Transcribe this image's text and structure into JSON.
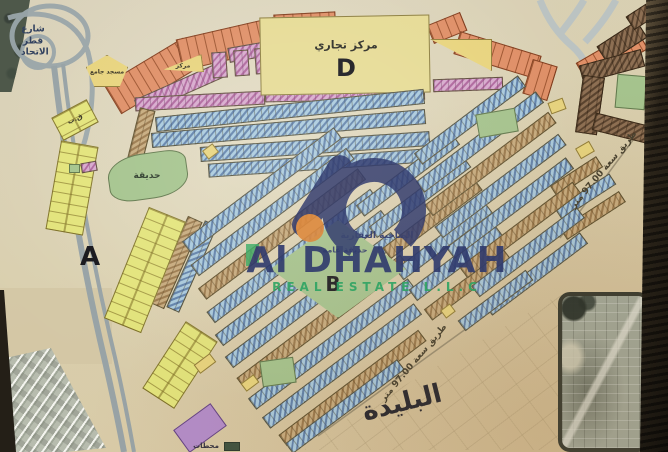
{
  "watermark": {
    "name": "Al DHAHYAH",
    "subtitle": "REAL ESTATE L.L.C",
    "arabic_name": "الضاحية العقارية",
    "colors": {
      "navy": "#2f3a6d",
      "green": "#2ea463",
      "orange": "#dd8a3f"
    }
  },
  "map": {
    "zone_letters": [
      "A",
      "B",
      "D"
    ],
    "colors": {
      "residential_blue": "#a9cade",
      "residential_khaki": "#c7ab7e",
      "commercial_pink": "#d7a9cd",
      "plots_orange": "#df8f67",
      "plots_yellow": "#e3e47c",
      "special_brown": "#8d6f53",
      "park_green": "#a5c48e",
      "utility_purple": "#b38cc9",
      "big_block_yellow": "#e6db95"
    },
    "labels": [
      {
        "id": "zone-label-a",
        "text": "A",
        "cx": 90,
        "cy": 257,
        "size": 26,
        "weight": 800,
        "color": "#17171c"
      },
      {
        "id": "zone-label-b",
        "text": "B",
        "cx": 333,
        "cy": 284,
        "size": 20,
        "weight": 800,
        "color": "#17171c"
      },
      {
        "id": "zone-label-d",
        "text": "D",
        "cx": 346,
        "cy": 68,
        "size": 24,
        "weight": 800,
        "color": "#17171c"
      },
      {
        "id": "commercial-center-label",
        "text": "مركز تجاري",
        "cx": 346,
        "cy": 45,
        "size": 11,
        "weight": 700,
        "color": "#2b2b25"
      },
      {
        "id": "park-left-label",
        "text": "حديقة",
        "cx": 147,
        "cy": 176,
        "size": 9,
        "weight": 700,
        "color": "#2e3c2c"
      },
      {
        "id": "park-b-label",
        "text": "حديقة عامة",
        "cx": 345,
        "cy": 250,
        "size": 8,
        "weight": 700,
        "color": "#33406b"
      },
      {
        "id": "district-name-label",
        "text": "البليدة",
        "cx": 402,
        "cy": 403,
        "size": 26,
        "weight": 800,
        "color": "#26262e",
        "rot": -14
      },
      {
        "id": "road-97-right-label",
        "text": "طريق سعة 97.00 متر",
        "cx": 604,
        "cy": 170,
        "size": 9,
        "weight": 700,
        "color": "#453f2e",
        "rot": -50
      },
      {
        "id": "road-97-bottom-label",
        "text": "طريق سعة 97.00 متر",
        "cx": 414,
        "cy": 363,
        "size": 9,
        "weight": 700,
        "color": "#453f2e",
        "rot": -50
      },
      {
        "id": "street-left-label",
        "text": "شارع قطر الاتحاد",
        "cx": 33,
        "cy": 42,
        "size": 9,
        "weight": 700,
        "color": "#31415f",
        "w": 24,
        "cls": "lbl-wrap"
      },
      {
        "id": "mosque-label",
        "text": "مسجد جامع",
        "cx": 107,
        "cy": 72,
        "size": 6,
        "weight": 700,
        "color": "#3a3525"
      },
      {
        "id": "center-small-label",
        "text": "مركز",
        "cx": 183,
        "cy": 66,
        "size": 6,
        "weight": 700,
        "color": "#3a3525"
      },
      {
        "id": "stations-label",
        "text": "محطات",
        "cx": 206,
        "cy": 446,
        "size": 7,
        "weight": 700,
        "color": "#33303f"
      },
      {
        "id": "qb-label",
        "text": "ق.ب",
        "cx": 75,
        "cy": 119,
        "size": 7,
        "weight": 700,
        "color": "#3a3525",
        "rot": -25
      }
    ],
    "blocks": [
      {
        "cx": 152,
        "cy": 76,
        "w": 92,
        "h": 34,
        "r": -31,
        "p": "orange"
      },
      {
        "cx": 228,
        "cy": 44,
        "w": 100,
        "h": 32,
        "r": -13,
        "p": "orange"
      },
      {
        "cx": 305,
        "cy": 27,
        "w": 62,
        "h": 28,
        "r": -3,
        "p": "orange"
      },
      {
        "cx": 447,
        "cy": 28,
        "w": 36,
        "h": 20,
        "r": -22,
        "p": "orange"
      },
      {
        "cx": 497,
        "cy": 55,
        "w": 85,
        "h": 24,
        "r": 17,
        "p": "orange"
      },
      {
        "cx": 540,
        "cy": 80,
        "w": 26,
        "h": 36,
        "r": 17,
        "p": "orange"
      },
      {
        "cx": 612,
        "cy": 56,
        "w": 70,
        "h": 24,
        "r": -30,
        "p": "orange"
      },
      {
        "cx": 180,
        "cy": 88,
        "w": 95,
        "h": 16,
        "r": -24,
        "p": "pink"
      },
      {
        "cx": 268,
        "cy": 48,
        "w": 80,
        "h": 15,
        "r": -10,
        "p": "pink"
      },
      {
        "cx": 219,
        "cy": 65,
        "w": 15,
        "h": 26,
        "r": -4,
        "p": "pink"
      },
      {
        "cx": 241,
        "cy": 63,
        "w": 15,
        "h": 26,
        "r": -4,
        "p": "pink"
      },
      {
        "cx": 262,
        "cy": 61,
        "w": 15,
        "h": 26,
        "r": -4,
        "p": "pink"
      },
      {
        "cx": 200,
        "cy": 101,
        "w": 130,
        "h": 14,
        "r": -3,
        "p": "pink"
      },
      {
        "cx": 345,
        "cy": 94,
        "w": 160,
        "h": 13,
        "r": -1,
        "p": "pink"
      },
      {
        "cx": 468,
        "cy": 84,
        "w": 70,
        "h": 13,
        "r": -2,
        "p": "pink"
      },
      {
        "cx": 345,
        "cy": 55,
        "w": 170,
        "h": 78,
        "r": -1,
        "p": "bigyellow"
      },
      {
        "cx": 622,
        "cy": 42,
        "w": 48,
        "h": 20,
        "r": -33,
        "p": "brown"
      },
      {
        "cx": 640,
        "cy": 17,
        "w": 24,
        "h": 16,
        "r": -33,
        "p": "brown"
      },
      {
        "cx": 612,
        "cy": 66,
        "w": 64,
        "h": 18,
        "r": -15,
        "p": "brown"
      },
      {
        "cx": 590,
        "cy": 105,
        "w": 22,
        "h": 58,
        "r": 8,
        "p": "brown"
      },
      {
        "cx": 621,
        "cy": 128,
        "w": 56,
        "h": 18,
        "r": 14,
        "p": "brown"
      },
      {
        "cx": 576,
        "cy": 176,
        "w": 55,
        "h": 13,
        "r": -33,
        "p": "khaki"
      },
      {
        "cx": 585,
        "cy": 196,
        "w": 65,
        "h": 13,
        "r": -33,
        "p": "blue"
      },
      {
        "cx": 593,
        "cy": 215,
        "w": 70,
        "h": 13,
        "r": -33,
        "p": "khaki"
      },
      {
        "cx": 290,
        "cy": 110,
        "w": 270,
        "h": 15,
        "r": -6,
        "p": "blue"
      },
      {
        "cx": 288,
        "cy": 128,
        "w": 275,
        "h": 15,
        "r": -5,
        "p": "blue"
      },
      {
        "cx": 315,
        "cy": 146,
        "w": 230,
        "h": 15,
        "r": -4,
        "p": "blue"
      },
      {
        "cx": 318,
        "cy": 163,
        "w": 220,
        "h": 14,
        "r": -4,
        "p": "blue"
      },
      {
        "cx": 138,
        "cy": 148,
        "w": 16,
        "h": 80,
        "r": 14,
        "p": "khaki"
      },
      {
        "cx": 176,
        "cy": 262,
        "w": 16,
        "h": 95,
        "r": 24,
        "p": "khaki"
      },
      {
        "cx": 192,
        "cy": 266,
        "w": 14,
        "h": 95,
        "r": 24,
        "p": "blue"
      },
      {
        "cx": 262,
        "cy": 190,
        "w": 190,
        "h": 14,
        "r": -37,
        "p": "blue"
      },
      {
        "cx": 272,
        "cy": 212,
        "w": 195,
        "h": 14,
        "r": -37,
        "p": "blue"
      },
      {
        "cx": 282,
        "cy": 234,
        "w": 200,
        "h": 14,
        "r": -37,
        "p": "khaki"
      },
      {
        "cx": 292,
        "cy": 256,
        "w": 205,
        "h": 14,
        "r": -37,
        "p": "blue"
      },
      {
        "cx": 302,
        "cy": 278,
        "w": 208,
        "h": 14,
        "r": -37,
        "p": "blue"
      },
      {
        "cx": 312,
        "cy": 300,
        "w": 208,
        "h": 14,
        "r": -37,
        "p": "blue"
      },
      {
        "cx": 322,
        "cy": 322,
        "w": 205,
        "h": 14,
        "r": -37,
        "p": "khaki"
      },
      {
        "cx": 332,
        "cy": 344,
        "w": 200,
        "h": 14,
        "r": -37,
        "p": "blue"
      },
      {
        "cx": 342,
        "cy": 366,
        "w": 190,
        "h": 14,
        "r": -37,
        "p": "blue"
      },
      {
        "cx": 352,
        "cy": 388,
        "w": 175,
        "h": 14,
        "r": -37,
        "p": "khaki"
      },
      {
        "cx": 345,
        "cy": 406,
        "w": 140,
        "h": 13,
        "r": -37,
        "p": "blue"
      },
      {
        "cx": 408,
        "cy": 175,
        "w": 120,
        "h": 14,
        "r": -37,
        "p": "blue"
      },
      {
        "cx": 420,
        "cy": 197,
        "w": 118,
        "h": 14,
        "r": -37,
        "p": "blue"
      },
      {
        "cx": 432,
        "cy": 219,
        "w": 115,
        "h": 14,
        "r": -37,
        "p": "khaki"
      },
      {
        "cx": 444,
        "cy": 241,
        "w": 112,
        "h": 14,
        "r": -37,
        "p": "blue"
      },
      {
        "cx": 456,
        "cy": 263,
        "w": 108,
        "h": 14,
        "r": -37,
        "p": "blue"
      },
      {
        "cx": 468,
        "cy": 285,
        "w": 100,
        "h": 14,
        "r": -37,
        "p": "khaki"
      },
      {
        "cx": 470,
        "cy": 120,
        "w": 130,
        "h": 14,
        "r": -37,
        "p": "blue"
      },
      {
        "cx": 480,
        "cy": 142,
        "w": 150,
        "h": 14,
        "r": -37,
        "p": "blue"
      },
      {
        "cx": 490,
        "cy": 164,
        "w": 155,
        "h": 14,
        "r": -37,
        "p": "khaki"
      },
      {
        "cx": 500,
        "cy": 186,
        "w": 155,
        "h": 14,
        "r": -37,
        "p": "blue"
      },
      {
        "cx": 510,
        "cy": 208,
        "w": 150,
        "h": 14,
        "r": -37,
        "p": "blue"
      },
      {
        "cx": 520,
        "cy": 230,
        "w": 142,
        "h": 14,
        "r": -37,
        "p": "khaki"
      },
      {
        "cx": 528,
        "cy": 252,
        "w": 132,
        "h": 14,
        "r": -37,
        "p": "blue"
      },
      {
        "cx": 536,
        "cy": 274,
        "w": 120,
        "h": 14,
        "r": -37,
        "p": "blue"
      },
      {
        "cx": 495,
        "cy": 300,
        "w": 85,
        "h": 13,
        "r": -37,
        "p": "blue"
      },
      {
        "cx": 72,
        "cy": 188,
        "w": 38,
        "h": 90,
        "r": 10,
        "p": "yellow"
      },
      {
        "cx": 145,
        "cy": 270,
        "w": 40,
        "h": 120,
        "r": 22,
        "p": "yellow"
      },
      {
        "cx": 180,
        "cy": 365,
        "w": 38,
        "h": 80,
        "r": 33,
        "p": "yellow"
      },
      {
        "cx": 75,
        "cy": 120,
        "w": 40,
        "h": 26,
        "r": -28,
        "p": "yellow"
      },
      {
        "cx": 107,
        "cy": 71,
        "w": 42,
        "h": 32,
        "r": 0,
        "p": "gold",
        "s": "pent"
      },
      {
        "cx": 183,
        "cy": 66,
        "w": 40,
        "h": 18,
        "r": -8,
        "p": "gold",
        "s": "tri-l"
      },
      {
        "cx": 461,
        "cy": 55,
        "w": 62,
        "h": 32,
        "r": 0,
        "p": "gold",
        "s": "tri-r"
      },
      {
        "cx": 585,
        "cy": 150,
        "w": 16,
        "h": 12,
        "r": -30,
        "p": "gold"
      },
      {
        "cx": 557,
        "cy": 106,
        "w": 16,
        "h": 12,
        "r": -20,
        "p": "gold"
      },
      {
        "cx": 210,
        "cy": 151,
        "w": 13,
        "h": 11,
        "r": -37,
        "p": "gold"
      },
      {
        "cx": 205,
        "cy": 363,
        "w": 20,
        "h": 11,
        "r": -37,
        "p": "gold"
      },
      {
        "cx": 250,
        "cy": 383,
        "w": 16,
        "h": 10,
        "r": -37,
        "p": "gold"
      },
      {
        "cx": 352,
        "cy": 300,
        "w": 13,
        "h": 10,
        "r": -37,
        "p": "gold"
      },
      {
        "cx": 448,
        "cy": 311,
        "w": 12,
        "h": 10,
        "r": -37,
        "p": "gold"
      },
      {
        "cx": 148,
        "cy": 176,
        "w": 80,
        "h": 46,
        "r": -8,
        "p": "green",
        "s": "round"
      },
      {
        "cx": 497,
        "cy": 123,
        "w": 40,
        "h": 24,
        "r": -10,
        "p": "green"
      },
      {
        "cx": 278,
        "cy": 372,
        "w": 34,
        "h": 26,
        "r": -8,
        "p": "green"
      },
      {
        "cx": 631,
        "cy": 92,
        "w": 30,
        "h": 34,
        "r": 5,
        "p": "green"
      },
      {
        "cx": 74,
        "cy": 168,
        "w": 11,
        "h": 9,
        "r": 0,
        "p": "green"
      },
      {
        "cx": 89,
        "cy": 167,
        "w": 16,
        "h": 10,
        "r": -10,
        "p": "pink"
      },
      {
        "cx": 338,
        "cy": 269,
        "w": 135,
        "h": 98,
        "r": 0,
        "p": "green",
        "s": "diamond"
      },
      {
        "cx": 200,
        "cy": 428,
        "w": 46,
        "h": 28,
        "r": -36,
        "p": "purple"
      },
      {
        "cx": 232,
        "cy": 446,
        "w": 16,
        "h": 9,
        "r": 0,
        "p": "darkgreen"
      }
    ]
  }
}
